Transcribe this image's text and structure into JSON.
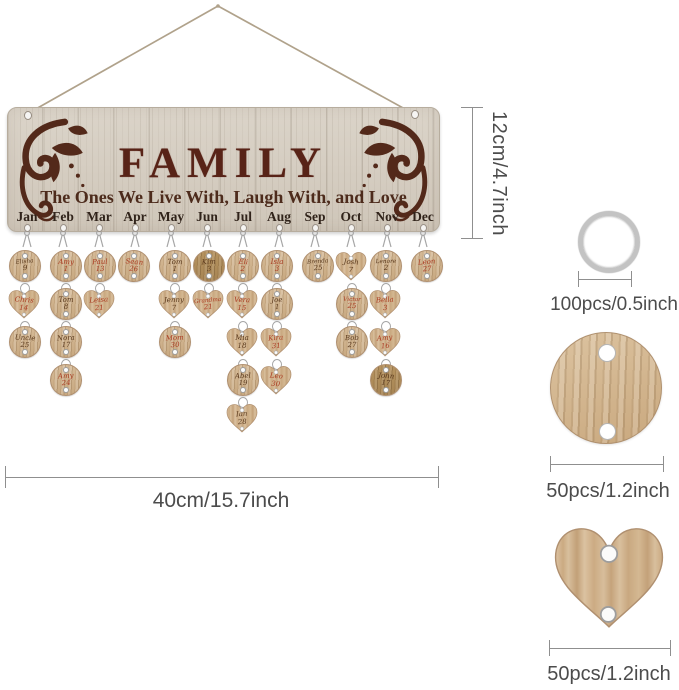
{
  "plaque": {
    "title": "FAMILY",
    "subtitle": "The Ones We Live With, Laugh With, and Love",
    "columns": [
      {
        "month": "Jan",
        "discs": [
          {
            "shape": "circle",
            "name": "Elisha",
            "num": "9",
            "ink": "dark"
          },
          {
            "shape": "heart",
            "name": "Chris",
            "num": "14",
            "ink": "red"
          },
          {
            "shape": "circle",
            "name": "Uncle",
            "num": "25",
            "ink": "dark"
          }
        ]
      },
      {
        "month": "Feb",
        "discs": [
          {
            "shape": "circle",
            "name": "Amy",
            "num": "1",
            "ink": "red"
          },
          {
            "shape": "circle",
            "name": "Tom",
            "num": "8",
            "ink": "dark"
          },
          {
            "shape": "circle",
            "name": "Nora",
            "num": "17",
            "ink": "dark"
          },
          {
            "shape": "circle",
            "name": "Amy",
            "num": "24",
            "ink": "red"
          }
        ]
      },
      {
        "month": "Mar",
        "discs": [
          {
            "shape": "circle",
            "name": "Paul",
            "num": "13",
            "ink": "red"
          },
          {
            "shape": "heart",
            "name": "Leisa",
            "num": "21",
            "ink": "red"
          }
        ]
      },
      {
        "month": "Apr",
        "discs": [
          {
            "shape": "circle",
            "name": "Sean",
            "num": "26",
            "ink": "red"
          }
        ]
      },
      {
        "month": "May",
        "discs": [
          {
            "shape": "circle",
            "name": "Tom",
            "num": "1",
            "ink": "dark"
          },
          {
            "shape": "heart",
            "name": "Jenny",
            "num": "7",
            "ink": "dark"
          },
          {
            "shape": "circle",
            "name": "Mom",
            "num": "30",
            "ink": "red"
          }
        ]
      },
      {
        "month": "Jun",
        "discs": [
          {
            "shape": "circle",
            "name": "Kim",
            "num": "3",
            "ink": "dark",
            "wood": "dark"
          },
          {
            "shape": "heart",
            "name": "Grandma",
            "num": "21",
            "ink": "red"
          }
        ]
      },
      {
        "month": "Jul",
        "discs": [
          {
            "shape": "circle",
            "name": "Eli",
            "num": "2",
            "ink": "red"
          },
          {
            "shape": "heart",
            "name": "Vera",
            "num": "15",
            "ink": "red"
          },
          {
            "shape": "heart",
            "name": "Mia",
            "num": "18",
            "ink": "dark"
          },
          {
            "shape": "circle",
            "name": "Abel",
            "num": "19",
            "ink": "dark"
          },
          {
            "shape": "heart",
            "name": "Ian",
            "num": "28",
            "ink": "dark"
          }
        ]
      },
      {
        "month": "Aug",
        "discs": [
          {
            "shape": "circle",
            "name": "Isla",
            "num": "3",
            "ink": "red"
          },
          {
            "shape": "circle",
            "name": "Joe",
            "num": "1",
            "ink": "dark"
          },
          {
            "shape": "heart",
            "name": "Kira",
            "num": "31",
            "ink": "red"
          },
          {
            "shape": "heart",
            "name": "Leo",
            "num": "30",
            "ink": "red"
          }
        ]
      },
      {
        "month": "Sep",
        "discs": [
          {
            "shape": "circle",
            "name": "Brenda",
            "num": "25",
            "ink": "dark"
          }
        ]
      },
      {
        "month": "Oct",
        "discs": [
          {
            "shape": "heart",
            "name": "Josh",
            "num": "7",
            "ink": "dark"
          },
          {
            "shape": "circle",
            "name": "Victor",
            "num": "25",
            "ink": "red"
          },
          {
            "shape": "circle",
            "name": "Bob",
            "num": "27",
            "ink": "dark"
          }
        ]
      },
      {
        "month": "Nov",
        "discs": [
          {
            "shape": "circle",
            "name": "Lenore",
            "num": "2",
            "ink": "dark"
          },
          {
            "shape": "heart",
            "name": "Bella",
            "num": "3",
            "ink": "red"
          },
          {
            "shape": "heart",
            "name": "Amy",
            "num": "16",
            "ink": "red"
          },
          {
            "shape": "circle",
            "name": "John",
            "num": "17",
            "ink": "dark",
            "wood": "dark"
          }
        ]
      },
      {
        "month": "Dec",
        "discs": [
          {
            "shape": "circle",
            "name": "Leon",
            "num": "27",
            "ink": "red"
          }
        ]
      }
    ]
  },
  "dimensions": {
    "board_height": "12cm/4.7inch",
    "board_width": "40cm/15.7inch"
  },
  "parts": {
    "ring": "100pcs/0.5inch",
    "round_disc": "50pcs/1.2inch",
    "heart_disc": "50pcs/1.2inch"
  },
  "colors": {
    "engraving": "#582317",
    "board_wood": "#d5cdc1",
    "disc_wood": "#cfae87",
    "ink_red": "#aa3a20",
    "ink_dark": "#5a391d",
    "dimension_line": "#8f8f8f"
  }
}
